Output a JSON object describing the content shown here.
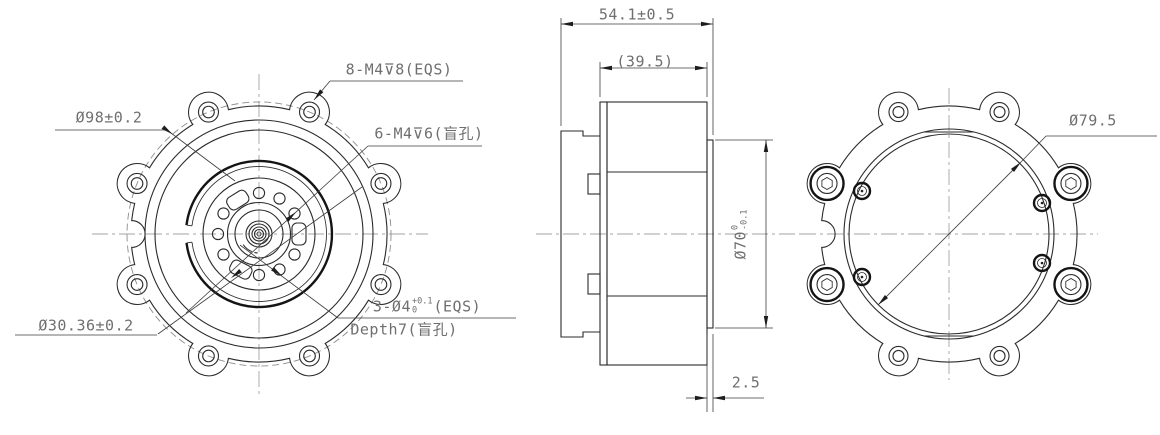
{
  "drawing": {
    "front": {
      "bolt_circle": "Ø98±0.2",
      "tap8": "8-M4⊽8(EQS)",
      "tap6": "6-M4⊽6(盲孔)",
      "pitch_circle": "Ø30.36±0.2",
      "pin": {
        "prefix": "3-Ø4",
        "tol_up": "+0.1",
        "tol_dn": "0",
        "suffix": "(EQS)",
        "depth": "Depth7(盲孔)"
      }
    },
    "side": {
      "overall": "54.1±0.5",
      "body_ref": "(39.5)",
      "spigot": {
        "prefix": "Ø70",
        "tol_up": "0",
        "tol_dn": "-0.1"
      },
      "spigot_thk": "2.5"
    },
    "rear": {
      "opening": "Ø79.5"
    }
  }
}
